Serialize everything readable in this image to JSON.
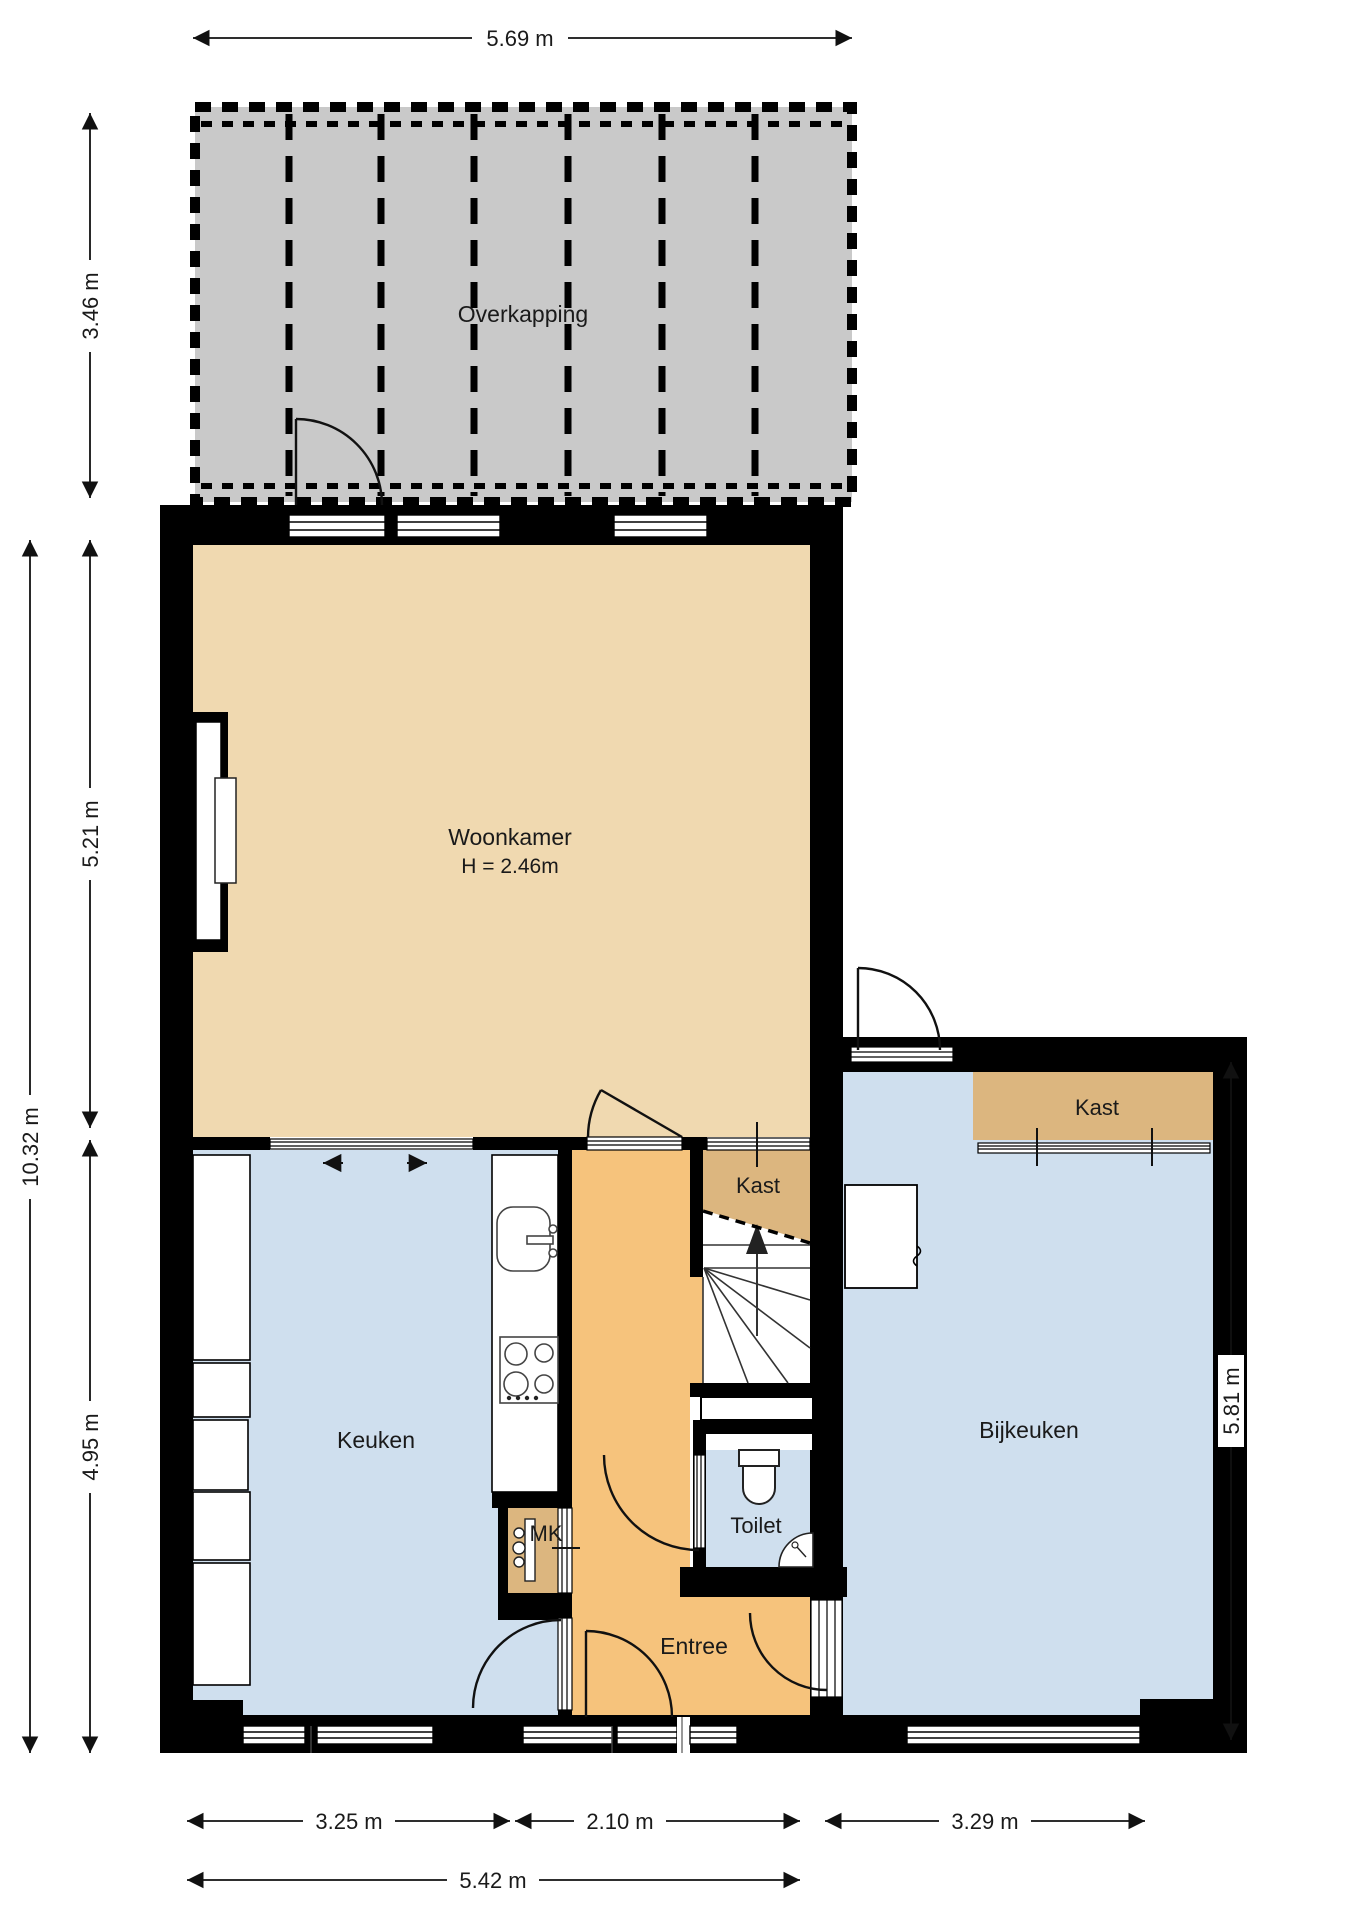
{
  "palette": {
    "wall": "#000000",
    "overkapping_fill": "#c9c9c9",
    "woonkamer_fill": "#f0d9b0",
    "entree_fill": "#f6c37c",
    "kast_fill": "#dcb67f",
    "wet_room_fill": "#cfdfee",
    "line_color": "#1a1a1a"
  },
  "rooms": {
    "overkapping": "Overkapping",
    "woonkamer": "Woonkamer",
    "woonkamer_height": "H = 2.46m",
    "keuken": "Keuken",
    "entree": "Entree",
    "toilet": "Toilet",
    "mk": "MK",
    "kast_stairs": "Kast",
    "kast_bijkeuken": "Kast",
    "bijkeuken": "Bijkeuken"
  },
  "dimensions": {
    "top_width": "5.69 m",
    "overkapping_depth": "3.46 m",
    "woonkamer_depth": "5.21 m",
    "total_depth": "10.32 m",
    "keuken_depth": "4.95 m",
    "bijkeuken_depth": "5.81 m",
    "keuken_width": "3.25 m",
    "entree_width": "2.10 m",
    "bijkeuken_width": "3.29 m",
    "total_width": "5.42 m"
  }
}
